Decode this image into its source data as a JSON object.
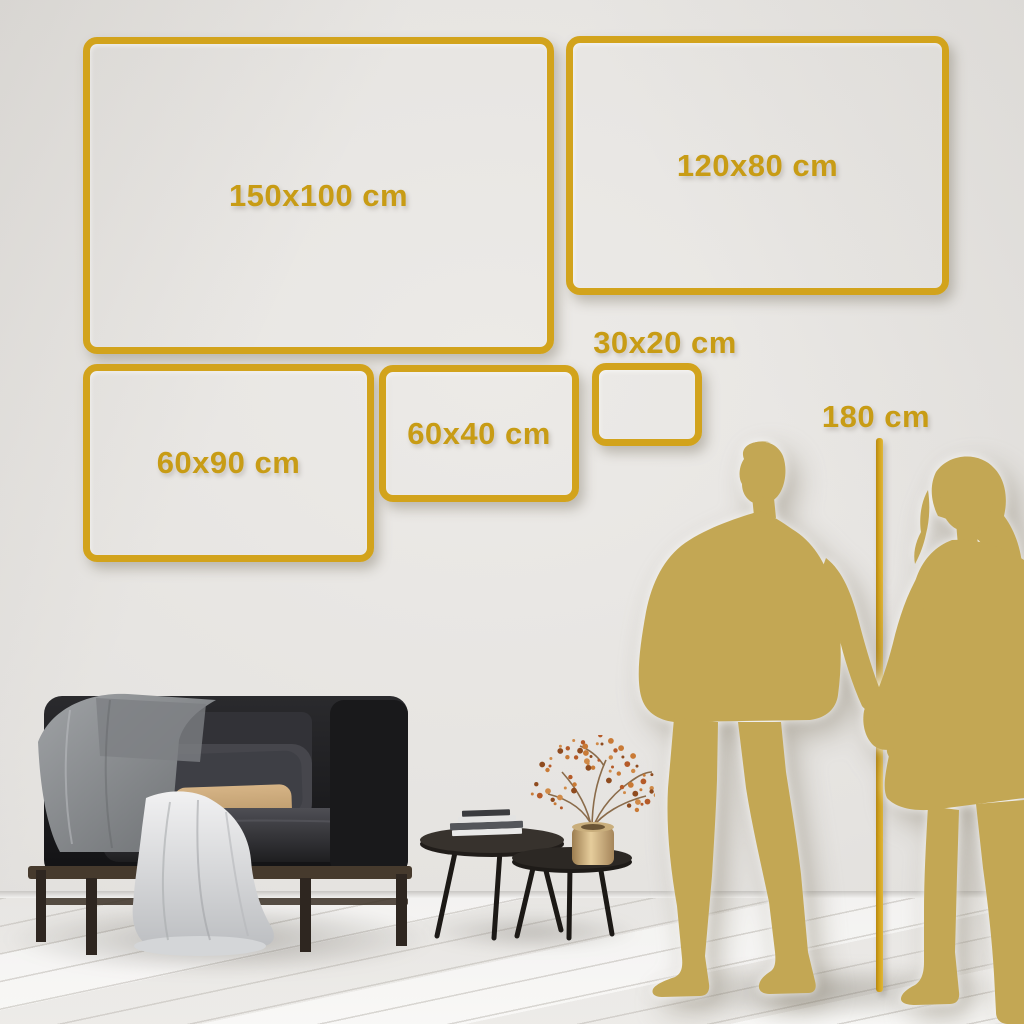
{
  "page": {
    "description": "Canvas wall-art size comparison guide in a living room"
  },
  "colors": {
    "gold": "#D2A31C",
    "gold_text": "#C89C15",
    "silhouette": "#C3A754",
    "wall": "#E4E2DF",
    "floor": "#F3F2F0"
  },
  "size_frames": [
    {
      "label": "150x100 cm"
    },
    {
      "label": "120x80 cm"
    },
    {
      "label": "60x90 cm"
    },
    {
      "label": "60x40 cm"
    },
    {
      "label": "30x20 cm"
    }
  ],
  "height_reference": {
    "label": "180 cm"
  }
}
